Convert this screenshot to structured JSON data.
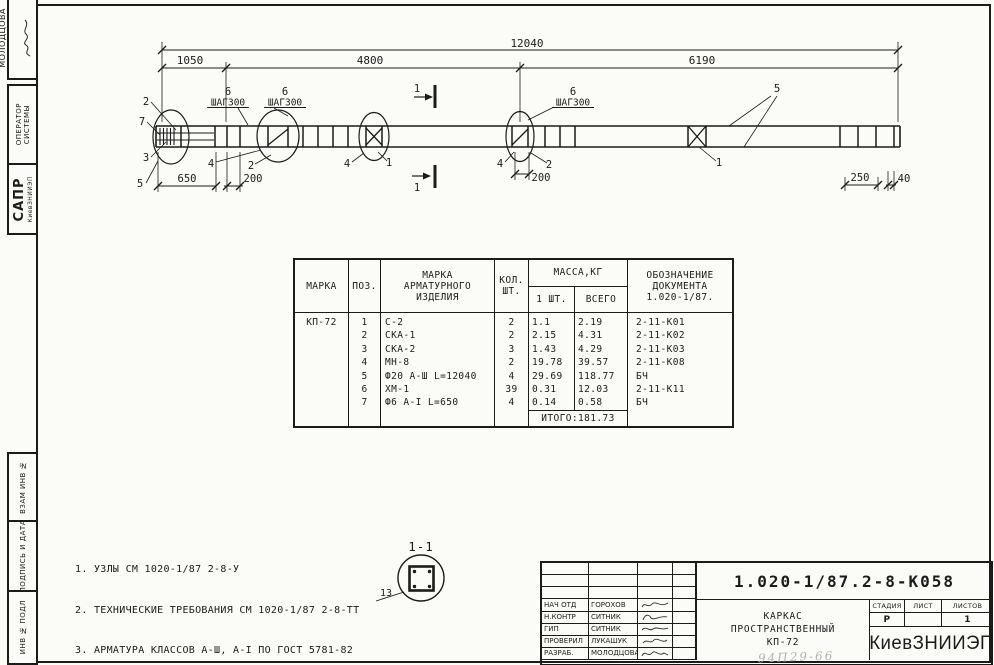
{
  "sidebar": {
    "author": "МОЛОДЦОВА",
    "op1": "ОПЕРАТОР",
    "op2": "СИСТЕМЫ",
    "sapr": "САПР",
    "sapr_sub": "КиевЗНИИЭП",
    "box_vzam": "ВЗАМ ИНВ №",
    "box_podp": "ПОДПИСЬ И ДАТА",
    "box_inv": "ИНВ № ПОДЛ"
  },
  "drawing": {
    "dim_total": "12040",
    "dim_seg1": "1050",
    "dim_seg2": "4800",
    "dim_seg3": "6190",
    "dim_650": "650",
    "dim_200": "200",
    "dim_250": "250",
    "dim_40": "40",
    "shag": "ШАГ300",
    "c1": "1",
    "c2": "2",
    "c3": "3",
    "c4": "4",
    "c5": "5",
    "c6": "6",
    "c7": "7",
    "c13": "13",
    "section_mark": "1",
    "section_title": "1-1"
  },
  "table": {
    "h_marka": "МАРКА",
    "h_poz": "ПОЗ.",
    "h_item1": "МАРКА",
    "h_item2": "АРМАТУРНОГО",
    "h_item3": "ИЗДЕЛИЯ",
    "h_qty1": "КОЛ.",
    "h_qty2": "ШТ.",
    "h_mass": "МАССА,КГ",
    "h_mass1": "1 ШТ.",
    "h_mass2": "ВСЕГО",
    "h_doc1": "ОБОЗНАЧЕНИЕ",
    "h_doc2": "ДОКУМЕНТА",
    "h_doc3": "1.020-1/87.",
    "mark": "КП-72",
    "rows": [
      {
        "pos": "1",
        "item": "С-2",
        "qty": "2",
        "m1": "1.1",
        "mt": "2.19",
        "doc": "2-11-К01"
      },
      {
        "pos": "2",
        "item": "СКА-1",
        "qty": "2",
        "m1": "2.15",
        "mt": "4.31",
        "doc": "2-11-К02"
      },
      {
        "pos": "3",
        "item": "СКА-2",
        "qty": "3",
        "m1": "1.43",
        "mt": "4.29",
        "doc": "2-11-К03"
      },
      {
        "pos": "4",
        "item": "МН-8",
        "qty": "2",
        "m1": "19.78",
        "mt": "39.57",
        "doc": "2-11-К08"
      },
      {
        "pos": "5",
        "item": "Ф20 А-Ш L=12040",
        "qty": "4",
        "m1": "29.69",
        "mt": "118.77",
        "doc": "БЧ"
      },
      {
        "pos": "6",
        "item": "ХМ-1",
        "qty": "39",
        "m1": "0.31",
        "mt": "12.03",
        "doc": "2-11-К11"
      },
      {
        "pos": "7",
        "item": "Ф6 А-I L=650",
        "qty": "4",
        "m1": "0.14",
        "mt": "0.58",
        "doc": "БЧ"
      }
    ],
    "total": "ИТОГО:181.73"
  },
  "notes": {
    "n1": "1. УЗЛЫ СМ 1020-1/87 2-8-У",
    "n2": "2. ТЕХНИЧЕСКИЕ ТРЕБОВАНИЯ СМ 1020-1/87 2-8-ТТ",
    "n3": "3. АРМАТУРА КЛАССОВ А-Ш, А-I ПО ГОСТ 5781-82"
  },
  "titleblock": {
    "doc_number": "1.020-1/87.2-8-К058",
    "rows": [
      {
        "role": "НАЧ ОТД",
        "name": "ГОРОХОВ"
      },
      {
        "role": "Н.КОНТР",
        "name": "СИТНИК"
      },
      {
        "role": "ГИП",
        "name": "СИТНИК"
      },
      {
        "role": "ПРОВЕРИЛ",
        "name": "ЛУКАШУК"
      },
      {
        "role": "РАЗРАБ.",
        "name": "МОЛОДЦОВА"
      }
    ],
    "title1": "КАРКАС",
    "title2": "ПРОСТРАНСТВЕННЫЙ",
    "title3": "КП-72",
    "stage_label": "СТАДИЯ",
    "sheet_label": "ЛИСТ",
    "sheets_label": "ЛИСТОВ",
    "stage": "Р",
    "sheet": "",
    "sheets": "1",
    "org": "КиевЗНИИЭП",
    "pencil": "94П29-66"
  }
}
